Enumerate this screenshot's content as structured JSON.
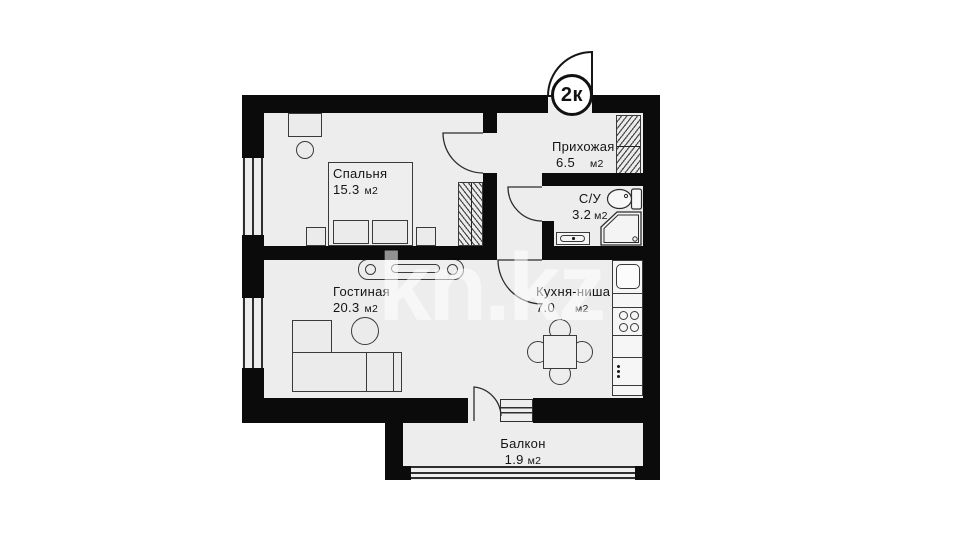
{
  "plan": {
    "badge": "2к",
    "watermark": "kn.kz",
    "rooms": [
      {
        "name": "Спальня",
        "area": "15.3",
        "unit": "м2"
      },
      {
        "name": "Прихожая",
        "area": "6.5",
        "unit": "м2"
      },
      {
        "name": "С/У",
        "area": "3.2",
        "unit": "м2"
      },
      {
        "name": "Гостиная",
        "area": "20.3",
        "unit": "м2"
      },
      {
        "name": "Кухня-ниша",
        "area": "7.0",
        "unit": "м2"
      },
      {
        "name": "Балкон",
        "area": "1.9",
        "unit": "м2"
      }
    ],
    "colors": {
      "wall": "#0b0b0b",
      "floor": "#ededed",
      "furniture_outline": "#3a3a3a",
      "watermark": "rgba(255,255,255,0.55)"
    },
    "furniture_icons": [
      "bed",
      "nightstand",
      "wardrobe",
      "desk",
      "stool",
      "tv-stand",
      "corner-sofa",
      "coffee-table",
      "dining-table",
      "chair",
      "kitchen-counter",
      "kitchen-sink",
      "cooktop",
      "toilet",
      "shower-cabin",
      "washbasin",
      "entry-door",
      "interior-door"
    ]
  }
}
